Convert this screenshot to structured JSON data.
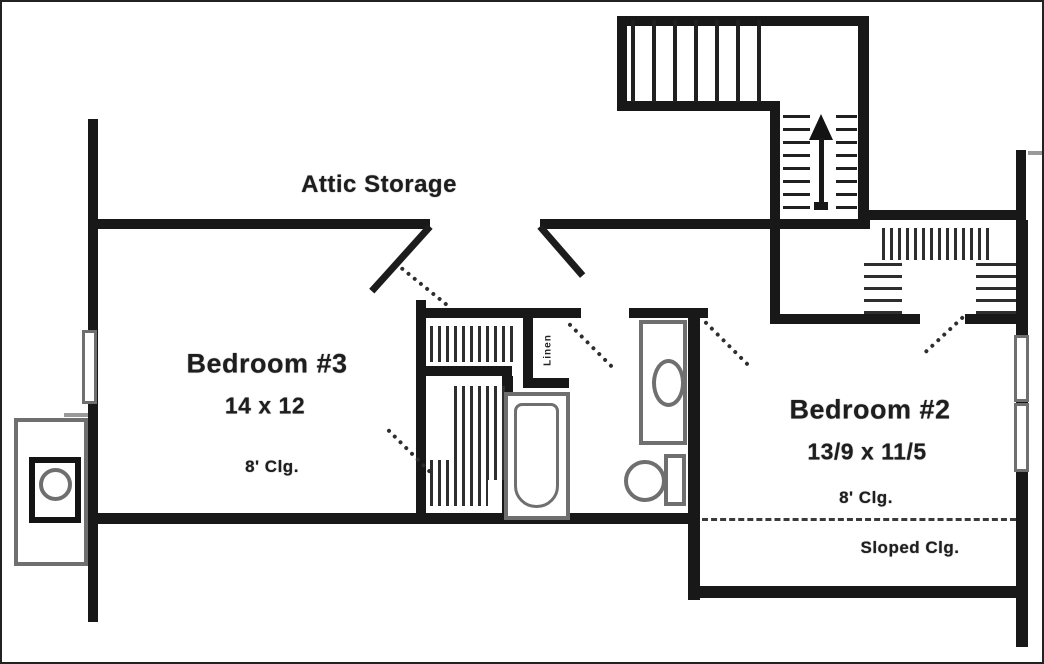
{
  "labels": {
    "attic_storage": "Attic Storage",
    "bedroom3": {
      "name": "Bedroom #3",
      "size": "14 x 12",
      "ceiling": "8' Clg."
    },
    "bedroom2": {
      "name": "Bedroom #2",
      "size": "13/9 x 11/5",
      "ceiling": "8' Clg.",
      "sloped": "Sloped Clg."
    },
    "linen": "Linen"
  },
  "icons": {
    "stair_arrow": "up-arrow"
  },
  "colors": {
    "wall": "#181818",
    "fixture": "#6f6f6f",
    "text": "#1e1e1e",
    "background": "#ffffff"
  }
}
